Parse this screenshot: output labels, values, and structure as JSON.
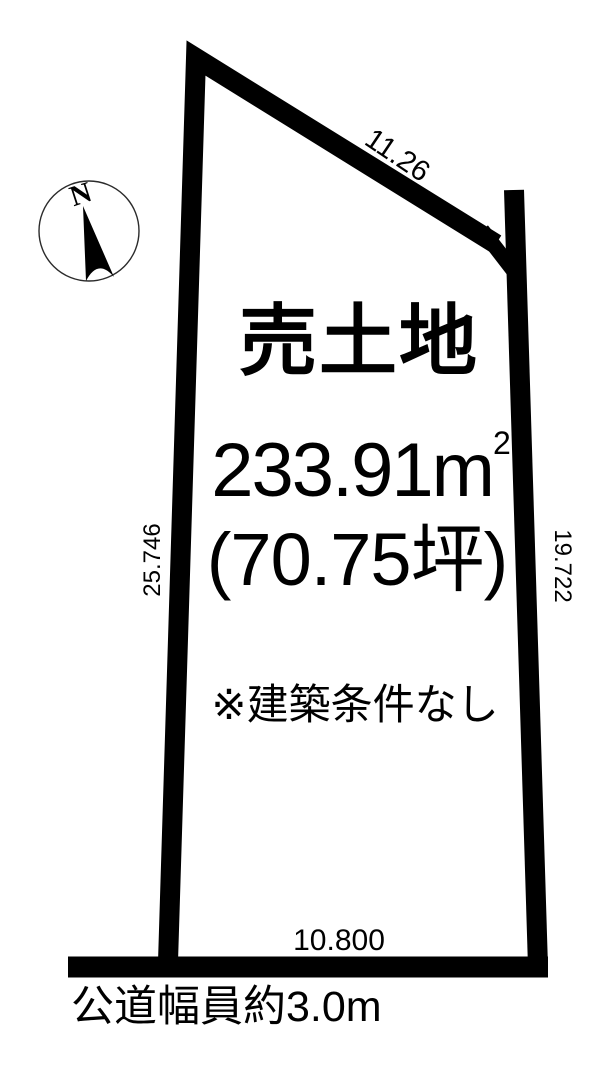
{
  "diagram": {
    "background_color": "#ffffff",
    "line_color": "#000000",
    "title": "売土地",
    "area_main": "233.91m",
    "area_exponent": "2",
    "area_tsubo": "(70.75坪)",
    "note": "※建築条件なし",
    "road_label": "公道幅員約3.0m",
    "dimensions": {
      "top_edge": "11.26",
      "left_edge": "25.746",
      "right_edge": "19.722",
      "bottom_edge": "10.800"
    },
    "compass": {
      "north": "N"
    }
  }
}
